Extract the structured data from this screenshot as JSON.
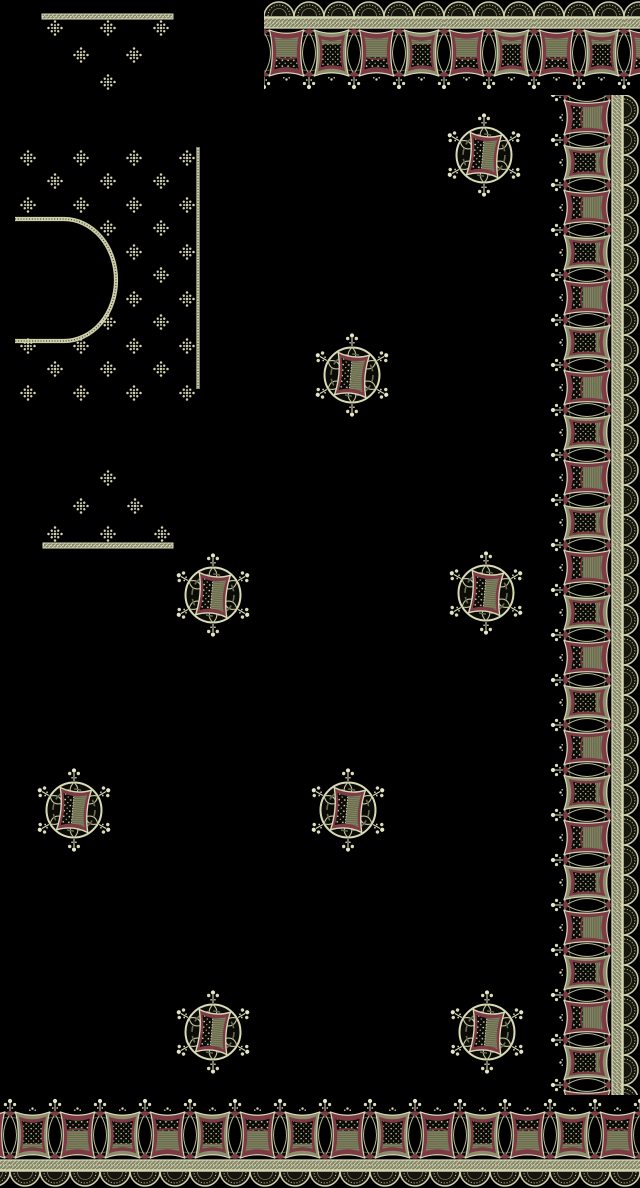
{
  "artwork": {
    "kind": "textile-embroidery-design",
    "width": 640,
    "height": 1188
  },
  "colors": {
    "ground": "#000000",
    "cream": "#d9dab6",
    "cream_bright": "#ecedd0",
    "khaki": "#8b8d6d",
    "khaki_deep": "#60624a",
    "maroon": "#7d3a45",
    "maroon_deep": "#5a2530",
    "ink": "#0d0d09"
  },
  "borders": {
    "strip_depth": 96,
    "solid_depth": 78,
    "repeat": 90,
    "right": {
      "x": 640,
      "y": 95,
      "rotate": 90,
      "length": 1000
    },
    "top": {
      "x": 264,
      "y": 0,
      "rotate": 0,
      "length": 376
    },
    "bottom": {
      "x": 640,
      "y": 1188,
      "rotate": 180,
      "length": 640
    }
  },
  "field_motifs": {
    "motif": "circular-buta",
    "count": 8,
    "positions": [
      [
        484,
        155
      ],
      [
        352,
        375
      ],
      [
        213,
        595
      ],
      [
        486,
        593
      ],
      [
        74,
        810
      ],
      [
        348,
        810
      ],
      [
        213,
        1032
      ],
      [
        487,
        1032
      ]
    ]
  },
  "blouse_panel": {
    "edge_line": {
      "x": 198,
      "y1": 147,
      "y2": 389
    },
    "neckline": {
      "left": 15,
      "top": 219,
      "bottom": 341,
      "shoulder": 64,
      "rx": 52,
      "ry": 61
    },
    "diamonds": [
      [
        28,
        158
      ],
      [
        81,
        158
      ],
      [
        134,
        158
      ],
      [
        187,
        158
      ],
      [
        55,
        181
      ],
      [
        108,
        181
      ],
      [
        161,
        181
      ],
      [
        28,
        205
      ],
      [
        81,
        205
      ],
      [
        134,
        205
      ],
      [
        187,
        205
      ],
      [
        108,
        228
      ],
      [
        161,
        228
      ],
      [
        134,
        252
      ],
      [
        187,
        252
      ],
      [
        161,
        275
      ],
      [
        134,
        299
      ],
      [
        187,
        299
      ],
      [
        108,
        322
      ],
      [
        161,
        322
      ],
      [
        28,
        346
      ],
      [
        81,
        346
      ],
      [
        134,
        346
      ],
      [
        187,
        346
      ],
      [
        55,
        369
      ],
      [
        108,
        369
      ],
      [
        161,
        369
      ],
      [
        28,
        393
      ],
      [
        81,
        393
      ],
      [
        134,
        393
      ],
      [
        187,
        393
      ]
    ]
  },
  "clusters": {
    "top": {
      "band": {
        "x": 42,
        "y": 14,
        "w": 131,
        "h": 5
      },
      "diamonds": [
        [
          55,
          28
        ],
        [
          108,
          28
        ],
        [
          161,
          28
        ],
        [
          81,
          55
        ],
        [
          134,
          55
        ],
        [
          108,
          82
        ]
      ]
    },
    "bottom": {
      "band": {
        "x": 43,
        "y": 543,
        "w": 130,
        "h": 5
      },
      "diamonds": [
        [
          108,
          478
        ],
        [
          81,
          506
        ],
        [
          135,
          506
        ],
        [
          55,
          534
        ],
        [
          108,
          534
        ],
        [
          162,
          534
        ]
      ]
    }
  }
}
